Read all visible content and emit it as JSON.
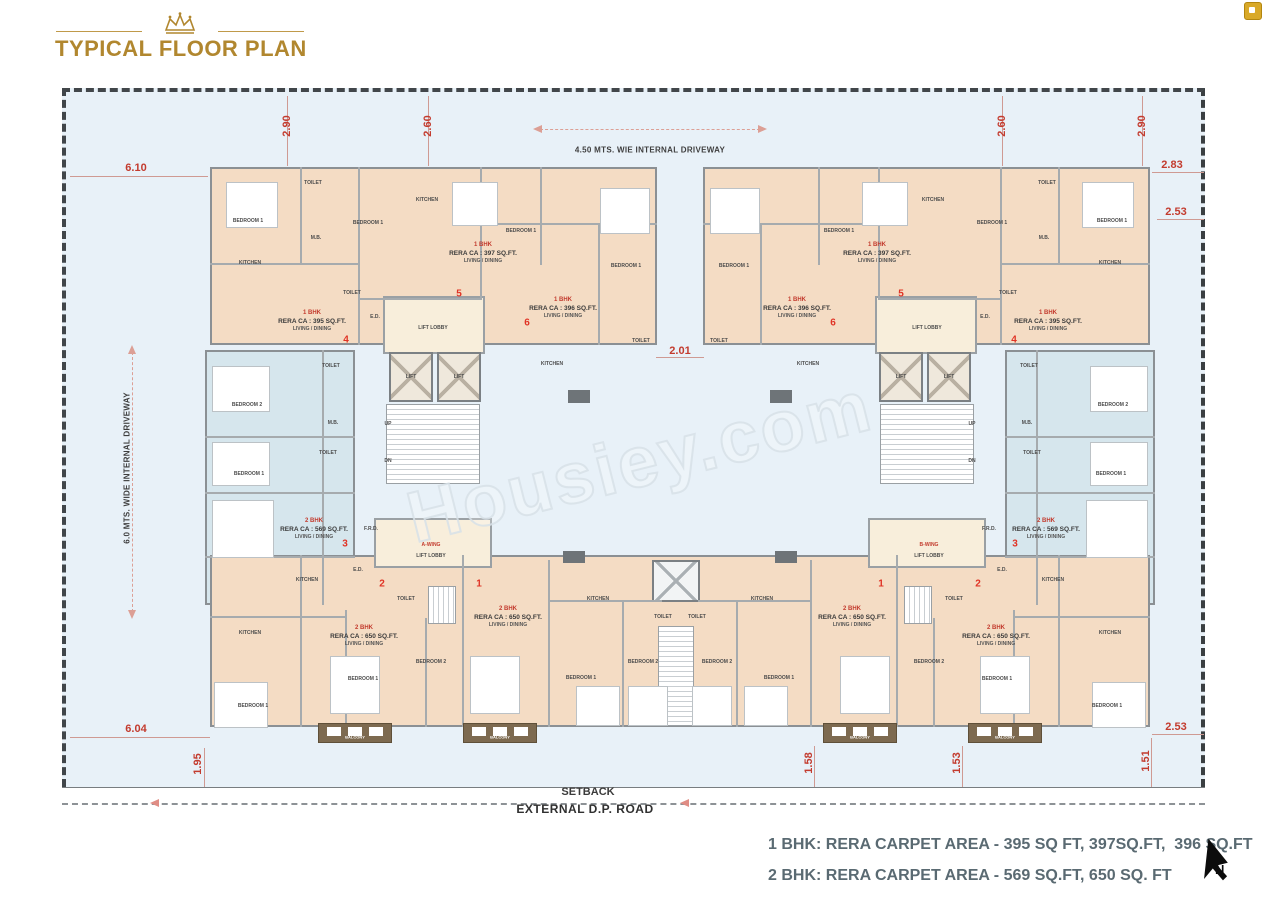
{
  "header": {
    "title": "TYPICAL FLOOR PLAN"
  },
  "site": {
    "setback": "SETBACK",
    "road": "EXTERNAL D.P. ROAD",
    "top_driveway": "4.50 MTS. WIE INTERNAL DRIVEWAY",
    "left_driveway": "6.0 MTS. WIDE INTERNAL DRIVEWAY",
    "watermark": "Housiey.com",
    "north": "N"
  },
  "legend": {
    "line1": "1 BHK: RERA CARPET AREA - 395 SQ FT, 397SQ.FT,  396 SQ.FT",
    "line2": "2 BHK: RERA CARPET AREA - 569 SQ.FT, 650 SQ. FT"
  },
  "colors": {
    "accent_gold": "#b1872f",
    "dimension_red": "#c33b2e",
    "unit_peach": "#f4dcc4",
    "unit_blue": "#d6e6ed",
    "lobby_cream": "#f8eedb",
    "balcony_brown": "#7d6a50",
    "plot_bg": "#e8f1f8"
  },
  "floorplan": {
    "dimensions": [
      {
        "t": "2.90",
        "x": 287,
        "y": 126,
        "v": 1
      },
      {
        "t": "2.60",
        "x": 428,
        "y": 126,
        "v": 1
      },
      {
        "t": "2.60",
        "x": 1002,
        "y": 126,
        "v": 1
      },
      {
        "t": "2.90",
        "x": 1142,
        "y": 126,
        "v": 1
      },
      {
        "t": "6.10",
        "x": 136,
        "y": 168
      },
      {
        "t": "2.83",
        "x": 1172,
        "y": 165
      },
      {
        "t": "2.53",
        "x": 1176,
        "y": 212
      },
      {
        "t": "2.01",
        "x": 680,
        "y": 351
      },
      {
        "t": "6.04",
        "x": 136,
        "y": 729
      },
      {
        "t": "2.53",
        "x": 1176,
        "y": 727
      },
      {
        "t": "1.95",
        "x": 198,
        "y": 764,
        "v": 1
      },
      {
        "t": "1.58",
        "x": 809,
        "y": 763,
        "v": 1
      },
      {
        "t": "1.53",
        "x": 957,
        "y": 763,
        "v": 1
      },
      {
        "t": "1.51",
        "x": 1146,
        "y": 761,
        "v": 1
      }
    ],
    "units": [
      {
        "x": 312,
        "y": 310,
        "lines": [
          "1 BHK",
          "RERA CA : 395 SQ.FT.",
          "LIVING / DINING"
        ]
      },
      {
        "x": 483,
        "y": 242,
        "lines": [
          "1 BHK",
          "RERA CA : 397 SQ.FT.",
          "LIVING / DINING"
        ]
      },
      {
        "x": 563,
        "y": 297,
        "lines": [
          "1 BHK",
          "RERA CA : 396 SQ.FT.",
          "LIVING / DINING"
        ]
      },
      {
        "x": 1048,
        "y": 310,
        "lines": [
          "1 BHK",
          "RERA CA : 395 SQ.FT.",
          "LIVING / DINING"
        ]
      },
      {
        "x": 877,
        "y": 242,
        "lines": [
          "1 BHK",
          "RERA CA : 397 SQ.FT.",
          "LIVING / DINING"
        ]
      },
      {
        "x": 797,
        "y": 297,
        "lines": [
          "1 BHK",
          "RERA CA : 396 SQ.FT.",
          "LIVING / DINING"
        ]
      },
      {
        "x": 314,
        "y": 518,
        "lines": [
          "2 BHK",
          "RERA CA : 569 SQ.FT.",
          "LIVING / DINING"
        ]
      },
      {
        "x": 1046,
        "y": 518,
        "lines": [
          "2 BHK",
          "RERA CA : 569 SQ.FT.",
          "LIVING / DINING"
        ]
      },
      {
        "x": 364,
        "y": 625,
        "lines": [
          "2 BHK",
          "RERA CA : 650 SQ.FT.",
          "LIVING / DINING"
        ]
      },
      {
        "x": 508,
        "y": 606,
        "lines": [
          "2 BHK",
          "RERA CA : 650 SQ.FT.",
          "LIVING / DINING"
        ]
      },
      {
        "x": 852,
        "y": 606,
        "lines": [
          "2 BHK",
          "RERA CA : 650 SQ.FT.",
          "LIVING / DINING"
        ]
      },
      {
        "x": 996,
        "y": 625,
        "lines": [
          "2 BHK",
          "RERA CA : 650 SQ.FT.",
          "LIVING / DINING"
        ]
      }
    ],
    "unit_numbers": [
      {
        "t": "4",
        "x": 346,
        "y": 340
      },
      {
        "t": "5",
        "x": 459,
        "y": 294
      },
      {
        "t": "6",
        "x": 527,
        "y": 323
      },
      {
        "t": "4",
        "x": 1014,
        "y": 340
      },
      {
        "t": "5",
        "x": 901,
        "y": 294
      },
      {
        "t": "6",
        "x": 833,
        "y": 323
      },
      {
        "t": "3",
        "x": 345,
        "y": 544
      },
      {
        "t": "3",
        "x": 1015,
        "y": 544
      },
      {
        "t": "2",
        "x": 382,
        "y": 584
      },
      {
        "t": "1",
        "x": 479,
        "y": 584
      },
      {
        "t": "1",
        "x": 881,
        "y": 584
      },
      {
        "t": "2",
        "x": 978,
        "y": 584
      }
    ],
    "rooms": [
      {
        "t": "BEDROOM 1",
        "x": 248,
        "y": 221
      },
      {
        "t": "TOILET",
        "x": 313,
        "y": 183
      },
      {
        "t": "M.B.",
        "x": 316,
        "y": 238
      },
      {
        "t": "KITCHEN",
        "x": 250,
        "y": 263
      },
      {
        "t": "BEDROOM 1",
        "x": 368,
        "y": 223
      },
      {
        "t": "TOILET",
        "x": 352,
        "y": 293
      },
      {
        "t": "E.D.",
        "x": 375,
        "y": 317
      },
      {
        "t": "KITCHEN",
        "x": 427,
        "y": 200
      },
      {
        "t": "BEDROOM 1",
        "x": 521,
        "y": 231
      },
      {
        "t": "LIFT LOBBY",
        "x": 433,
        "y": 328
      },
      {
        "t": "LIFT",
        "x": 411,
        "y": 377
      },
      {
        "t": "LIFT",
        "x": 459,
        "y": 377
      },
      {
        "t": "UP",
        "x": 388,
        "y": 424
      },
      {
        "t": "DN",
        "x": 388,
        "y": 461
      },
      {
        "t": "BEDROOM 1",
        "x": 626,
        "y": 266
      },
      {
        "t": "TOILET",
        "x": 641,
        "y": 341
      },
      {
        "t": "KITCHEN",
        "x": 552,
        "y": 364
      },
      {
        "t": "A-WING",
        "x": 431,
        "y": 545,
        "c": "red"
      },
      {
        "t": "LIFT LOBBY",
        "x": 431,
        "y": 556
      },
      {
        "t": "BEDROOM 1",
        "x": 1112,
        "y": 221
      },
      {
        "t": "TOILET",
        "x": 1047,
        "y": 183
      },
      {
        "t": "M.B.",
        "x": 1044,
        "y": 238
      },
      {
        "t": "KITCHEN",
        "x": 1110,
        "y": 263
      },
      {
        "t": "BEDROOM 1",
        "x": 992,
        "y": 223
      },
      {
        "t": "TOILET",
        "x": 1008,
        "y": 293
      },
      {
        "t": "E.D.",
        "x": 985,
        "y": 317
      },
      {
        "t": "KITCHEN",
        "x": 933,
        "y": 200
      },
      {
        "t": "BEDROOM 1",
        "x": 839,
        "y": 231
      },
      {
        "t": "LIFT LOBBY",
        "x": 927,
        "y": 328
      },
      {
        "t": "LIFT",
        "x": 949,
        "y": 377
      },
      {
        "t": "LIFT",
        "x": 901,
        "y": 377
      },
      {
        "t": "UP",
        "x": 972,
        "y": 424
      },
      {
        "t": "DN",
        "x": 972,
        "y": 461
      },
      {
        "t": "BEDROOM 1",
        "x": 734,
        "y": 266
      },
      {
        "t": "TOILET",
        "x": 719,
        "y": 341
      },
      {
        "t": "KITCHEN",
        "x": 808,
        "y": 364
      },
      {
        "t": "B-WING",
        "x": 929,
        "y": 545,
        "c": "red"
      },
      {
        "t": "LIFT LOBBY",
        "x": 929,
        "y": 556
      },
      {
        "t": "TOILET",
        "x": 331,
        "y": 366
      },
      {
        "t": "BEDROOM 2",
        "x": 247,
        "y": 405
      },
      {
        "t": "M.B.",
        "x": 333,
        "y": 423
      },
      {
        "t": "TOILET",
        "x": 328,
        "y": 453
      },
      {
        "t": "BEDROOM 1",
        "x": 249,
        "y": 474
      },
      {
        "t": "F.R.D.",
        "x": 371,
        "y": 529
      },
      {
        "t": "E.D.",
        "x": 358,
        "y": 570
      },
      {
        "t": "KITCHEN",
        "x": 307,
        "y": 580
      },
      {
        "t": "TOILET",
        "x": 1029,
        "y": 366
      },
      {
        "t": "BEDROOM 2",
        "x": 1113,
        "y": 405
      },
      {
        "t": "M.B.",
        "x": 1027,
        "y": 423
      },
      {
        "t": "TOILET",
        "x": 1032,
        "y": 453
      },
      {
        "t": "BEDROOM 1",
        "x": 1111,
        "y": 474
      },
      {
        "t": "F.R.D.",
        "x": 989,
        "y": 529
      },
      {
        "t": "E.D.",
        "x": 1002,
        "y": 570
      },
      {
        "t": "KITCHEN",
        "x": 1053,
        "y": 580
      },
      {
        "t": "KITCHEN",
        "x": 250,
        "y": 633
      },
      {
        "t": "BEDROOM 1",
        "x": 253,
        "y": 706
      },
      {
        "t": "TOILET",
        "x": 406,
        "y": 599
      },
      {
        "t": "BEDROOM 1",
        "x": 363,
        "y": 679
      },
      {
        "t": "BEDROOM 2",
        "x": 431,
        "y": 662
      },
      {
        "t": "KITCHEN",
        "x": 598,
        "y": 599
      },
      {
        "t": "TOILET",
        "x": 663,
        "y": 617
      },
      {
        "t": "TOILET",
        "x": 697,
        "y": 617
      },
      {
        "t": "BEDROOM 2",
        "x": 643,
        "y": 662
      },
      {
        "t": "BEDROOM 1",
        "x": 581,
        "y": 678
      },
      {
        "t": "BEDROOM 1",
        "x": 779,
        "y": 678
      },
      {
        "t": "BEDROOM 2",
        "x": 717,
        "y": 662
      },
      {
        "t": "KITCHEN",
        "x": 762,
        "y": 599
      },
      {
        "t": "TOILET",
        "x": 954,
        "y": 599
      },
      {
        "t": "BEDROOM 2",
        "x": 929,
        "y": 662
      },
      {
        "t": "BEDROOM 1",
        "x": 997,
        "y": 679
      },
      {
        "t": "KITCHEN",
        "x": 1110,
        "y": 633
      },
      {
        "t": "BEDROOM 1",
        "x": 1107,
        "y": 706
      },
      {
        "t": "BALCONY",
        "x": 355,
        "y": 737,
        "c": "white"
      },
      {
        "t": "BALCONY",
        "x": 500,
        "y": 737,
        "c": "white"
      },
      {
        "t": "BALCONY",
        "x": 860,
        "y": 737,
        "c": "white"
      },
      {
        "t": "BALCONY",
        "x": 1005,
        "y": 737,
        "c": "white"
      }
    ]
  }
}
